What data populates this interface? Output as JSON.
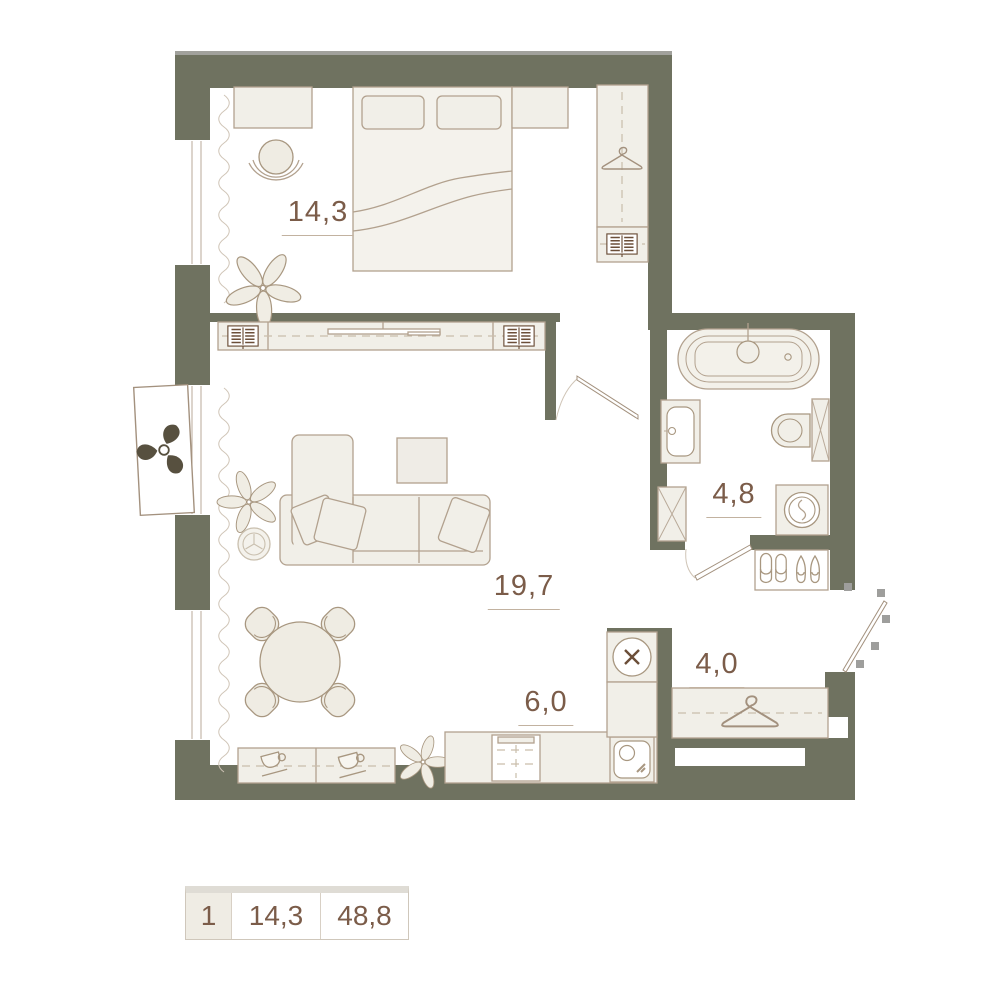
{
  "plan": {
    "areas": {
      "bedroom": "14,3",
      "living_room": "19,7",
      "kitchen": "6,0",
      "bathroom": "4,8",
      "hallway": "4,0"
    }
  },
  "legend": {
    "unit_number": "1",
    "first_room_area": "14,3",
    "total_area": "48,8"
  },
  "colors": {
    "wall": "#6f7260",
    "furniture_fill": "#f1efe8",
    "furniture_stroke": "#b2a18e",
    "label_text": "#7b5c49",
    "door_swing_marker": "#9e9e9c",
    "fan_blade": "#57503f",
    "legend_cell_bg": "#efece4"
  },
  "icons": [
    "bed-icon",
    "pillow-icon",
    "desk-icon",
    "office-chair-icon",
    "plant-icon",
    "hanger-icon",
    "radiator-icon",
    "tv-icon",
    "curtain-icon",
    "sofa-icon",
    "coffee-table-icon",
    "stool-icon",
    "dining-table-icon",
    "dining-chair-icon",
    "coffee-cup-icon",
    "sideboard-icon",
    "kitchen-counter-icon",
    "oven-icon",
    "cooktop-icon",
    "kitchen-sink-icon",
    "bathtub-icon",
    "washbasin-icon",
    "toilet-icon",
    "washing-machine-icon",
    "shower-cabinet-icon",
    "slippers-icon",
    "shoes-icon",
    "ac-fan-icon",
    "door-leaf-icon",
    "window-icon",
    "wardrobe-icon"
  ]
}
